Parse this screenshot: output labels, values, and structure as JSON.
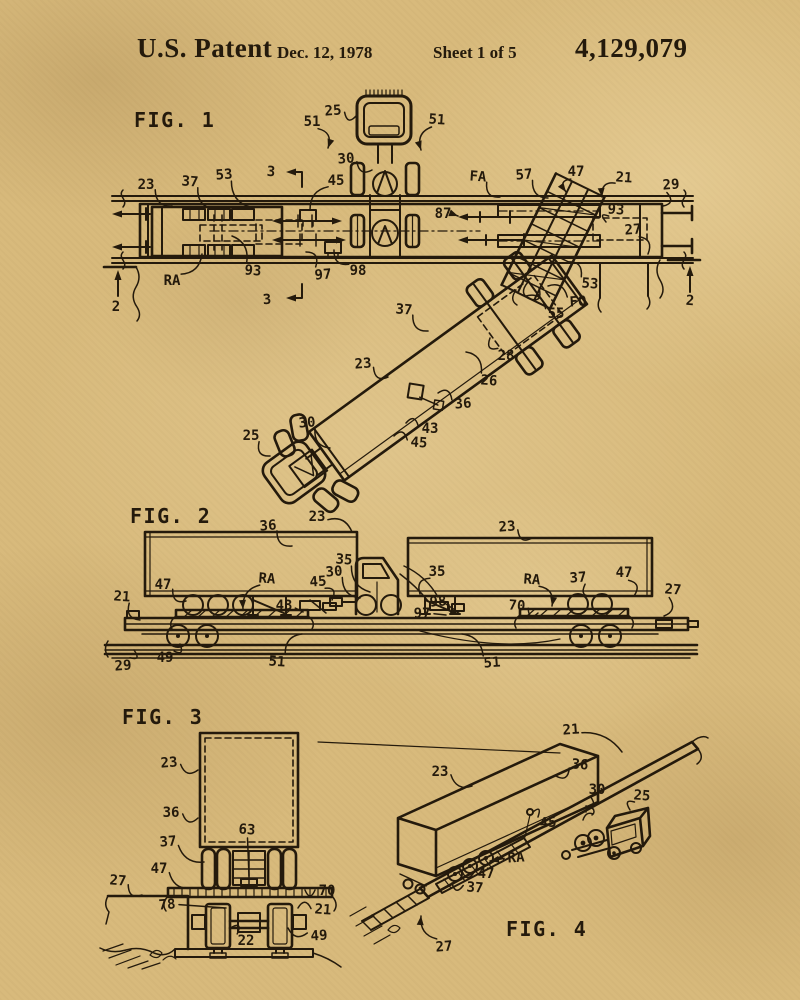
{
  "page": {
    "background": "#d8ba7c",
    "ink": "#241a0c"
  },
  "header": {
    "title": "U.S. Patent",
    "date": "Dec. 12, 1978",
    "sheet": "Sheet 1 of 5",
    "patent_number": "4,129,079"
  },
  "figures": [
    {
      "id": "fig1",
      "title": "FIG. 1",
      "title_pos": {
        "x": 134,
        "y": 127
      },
      "labels": [
        {
          "t": "25",
          "x": 333,
          "y": 110,
          "tx": 356,
          "ty": 116
        },
        {
          "t": "51",
          "x": 312,
          "y": 121,
          "tx": 328,
          "ty": 148,
          "arrow": 1,
          "bend": -1
        },
        {
          "t": "51",
          "x": 437,
          "y": 119,
          "tx": 421,
          "ty": 150,
          "arrow": 1
        },
        {
          "t": "30",
          "x": 346,
          "y": 158,
          "tx": 372,
          "ty": 170
        },
        {
          "t": "23",
          "x": 146,
          "y": 184,
          "tx": 172,
          "ty": 206
        },
        {
          "t": "37",
          "x": 190,
          "y": 181,
          "tx": 214,
          "ty": 209
        },
        {
          "t": "53",
          "x": 224,
          "y": 174,
          "tx": 250,
          "ty": 207
        },
        {
          "t": "45",
          "x": 336,
          "y": 180,
          "tx": 310,
          "ty": 210
        },
        {
          "t": "FA",
          "x": 478,
          "y": 176,
          "tx": 500,
          "ty": 197
        },
        {
          "t": "57",
          "x": 524,
          "y": 174,
          "tx": 548,
          "ty": 198
        },
        {
          "t": "47",
          "x": 576,
          "y": 171,
          "tx": 566,
          "ty": 192,
          "arrow": 1
        },
        {
          "t": "21",
          "x": 624,
          "y": 177,
          "tx": 602,
          "ty": 197,
          "arrow": 1
        },
        {
          "t": "29",
          "x": 671,
          "y": 184,
          "tx": 663,
          "ty": 206,
          "bend": -1
        },
        {
          "t": "87",
          "x": 443,
          "y": 213,
          "tx": 458,
          "ty": 216,
          "arrow": 1,
          "bend": 0
        },
        {
          "t": "93",
          "x": 616,
          "y": 209,
          "tx": 606,
          "ty": 222
        },
        {
          "t": "27",
          "x": 633,
          "y": 229,
          "tx": 648,
          "ty": 254,
          "bend": -1
        },
        {
          "t": "RA",
          "x": 172,
          "y": 280,
          "tx": 202,
          "ty": 254
        },
        {
          "t": "93",
          "x": 253,
          "y": 270,
          "tx": 232,
          "ty": 236
        },
        {
          "t": "97",
          "x": 323,
          "y": 274,
          "tx": 306,
          "ty": 252
        },
        {
          "t": "98",
          "x": 358,
          "y": 270,
          "tx": 334,
          "ty": 250,
          "bend": -1
        },
        {
          "t": "53",
          "x": 590,
          "y": 283,
          "tx": 568,
          "ty": 262
        },
        {
          "t": "FO",
          "x": 578,
          "y": 301,
          "tx": 548,
          "ty": 286
        },
        {
          "t": "55",
          "x": 556,
          "y": 313,
          "tx": 526,
          "ty": 296
        },
        {
          "t": "37",
          "x": 404,
          "y": 309,
          "tx": 428,
          "ty": 331
        },
        {
          "t": "23",
          "x": 363,
          "y": 363,
          "tx": 388,
          "ty": 377
        },
        {
          "t": "28",
          "x": 506,
          "y": 355,
          "tx": 490,
          "ty": 338,
          "bend": -1
        },
        {
          "t": "26",
          "x": 489,
          "y": 380,
          "tx": 466,
          "ty": 352
        },
        {
          "t": "36",
          "x": 463,
          "y": 403,
          "tx": 438,
          "ty": 393
        },
        {
          "t": "43",
          "x": 430,
          "y": 428,
          "tx": 406,
          "ty": 423
        },
        {
          "t": "45",
          "x": 419,
          "y": 442,
          "tx": 394,
          "ty": 436
        },
        {
          "t": "30",
          "x": 307,
          "y": 422,
          "tx": 330,
          "ty": 448
        },
        {
          "t": "25",
          "x": 251,
          "y": 435,
          "tx": 270,
          "ty": 456
        },
        {
          "t": "3",
          "x": 271,
          "y": 171
        },
        {
          "t": "3",
          "x": 267,
          "y": 299
        },
        {
          "t": "2",
          "x": 116,
          "y": 306
        },
        {
          "t": "2",
          "x": 690,
          "y": 300
        }
      ]
    },
    {
      "id": "fig2",
      "title": "FIG. 2",
      "title_pos": {
        "x": 130,
        "y": 523
      },
      "labels": [
        {
          "t": "36",
          "x": 268,
          "y": 525,
          "tx": 292,
          "ty": 546
        },
        {
          "t": "23",
          "x": 317,
          "y": 516,
          "tx": 352,
          "ty": 532,
          "bend": -1
        },
        {
          "t": "35",
          "x": 344,
          "y": 559,
          "tx": 370,
          "ty": 592
        },
        {
          "t": "30",
          "x": 334,
          "y": 571,
          "tx": 360,
          "ty": 598
        },
        {
          "t": "47",
          "x": 163,
          "y": 584,
          "tx": 186,
          "ty": 601
        },
        {
          "t": "RA",
          "x": 267,
          "y": 578,
          "tx": 243,
          "ty": 609,
          "arrow": 1
        },
        {
          "t": "45",
          "x": 318,
          "y": 581,
          "tx": 332,
          "ty": 600,
          "bend": -1
        },
        {
          "t": "43",
          "x": 284,
          "y": 605,
          "tx": 303,
          "ty": 612,
          "bend": 0
        },
        {
          "t": "21",
          "x": 122,
          "y": 596,
          "tx": 140,
          "ty": 620
        },
        {
          "t": "29",
          "x": 123,
          "y": 665,
          "tx": 134,
          "ty": 650
        },
        {
          "t": "49",
          "x": 165,
          "y": 657,
          "tx": 180,
          "ty": 644
        },
        {
          "t": "51",
          "x": 277,
          "y": 661,
          "tx": 302,
          "ty": 634,
          "bend": -1
        },
        {
          "t": "23",
          "x": 507,
          "y": 526,
          "tx": 532,
          "ty": 538
        },
        {
          "t": "35",
          "x": 437,
          "y": 571,
          "tx": 420,
          "ty": 594
        },
        {
          "t": "RA",
          "x": 532,
          "y": 579,
          "tx": 552,
          "ty": 606,
          "arrow": 1,
          "bend": -1
        },
        {
          "t": "37",
          "x": 578,
          "y": 577,
          "tx": 592,
          "ty": 596
        },
        {
          "t": "47",
          "x": 624,
          "y": 572,
          "tx": 634,
          "ty": 596,
          "bend": -1
        },
        {
          "t": "27",
          "x": 673,
          "y": 589,
          "tx": 664,
          "ty": 616,
          "bend": -1
        },
        {
          "t": "98",
          "x": 438,
          "y": 601,
          "tx": 460,
          "ty": 611
        },
        {
          "t": "97",
          "x": 422,
          "y": 613,
          "tx": 446,
          "ty": 615,
          "bend": 0
        },
        {
          "t": "70",
          "x": 517,
          "y": 605,
          "tx": 538,
          "ty": 613
        },
        {
          "t": "51",
          "x": 492,
          "y": 662,
          "tx": 462,
          "ty": 634
        }
      ]
    },
    {
      "id": "fig3",
      "title": "FIG. 3",
      "title_pos": {
        "x": 122,
        "y": 724
      },
      "labels": [
        {
          "t": "23",
          "x": 169,
          "y": 762,
          "tx": 198,
          "ty": 770
        },
        {
          "t": "36",
          "x": 171,
          "y": 812,
          "tx": 198,
          "ty": 818
        },
        {
          "t": "63",
          "x": 247,
          "y": 829,
          "tx": 249,
          "ty": 876,
          "bend": 0
        },
        {
          "t": "37",
          "x": 168,
          "y": 841,
          "tx": 204,
          "ty": 862
        },
        {
          "t": "47",
          "x": 159,
          "y": 868,
          "tx": 192,
          "ty": 888
        },
        {
          "t": "27",
          "x": 118,
          "y": 880,
          "tx": 142,
          "ty": 895
        },
        {
          "t": "78",
          "x": 167,
          "y": 904,
          "tx": 226,
          "ty": 908,
          "bend": 0
        },
        {
          "t": "70",
          "x": 327,
          "y": 890,
          "tx": 305,
          "ty": 890,
          "bend": -1
        },
        {
          "t": "21",
          "x": 323,
          "y": 909,
          "tx": 298,
          "ty": 908
        },
        {
          "t": "49",
          "x": 319,
          "y": 935,
          "tx": 288,
          "ty": 928,
          "bend": -1
        },
        {
          "t": "22",
          "x": 246,
          "y": 940,
          "tx": 232,
          "ty": 927
        }
      ]
    },
    {
      "id": "fig4",
      "title": "FIG. 4",
      "title_pos": {
        "x": 506,
        "y": 936
      },
      "labels": [
        {
          "t": "21",
          "x": 571,
          "y": 729,
          "tx": 622,
          "ty": 752,
          "bend": -1
        },
        {
          "t": "23",
          "x": 440,
          "y": 771,
          "tx": 472,
          "ty": 786
        },
        {
          "t": "36",
          "x": 580,
          "y": 764,
          "tx": 556,
          "ty": 776,
          "bend": -1
        },
        {
          "t": "45",
          "x": 548,
          "y": 822,
          "tx": 533,
          "ty": 812
        },
        {
          "t": "30",
          "x": 597,
          "y": 789,
          "tx": 586,
          "ty": 806,
          "bend": -1
        },
        {
          "t": "25",
          "x": 642,
          "y": 795,
          "tx": 630,
          "ty": 810
        },
        {
          "t": "RA",
          "x": 516,
          "y": 857,
          "tx": 490,
          "ty": 861,
          "arrow": 1,
          "bend": 0
        },
        {
          "t": "47",
          "x": 486,
          "y": 873,
          "tx": 462,
          "ty": 871,
          "bend": -1
        },
        {
          "t": "37",
          "x": 475,
          "y": 887,
          "tx": 452,
          "ty": 883,
          "bend": -1
        },
        {
          "t": "27",
          "x": 444,
          "y": 946,
          "tx": 421,
          "ty": 916,
          "arrow": 1,
          "bend": -1
        }
      ]
    }
  ]
}
